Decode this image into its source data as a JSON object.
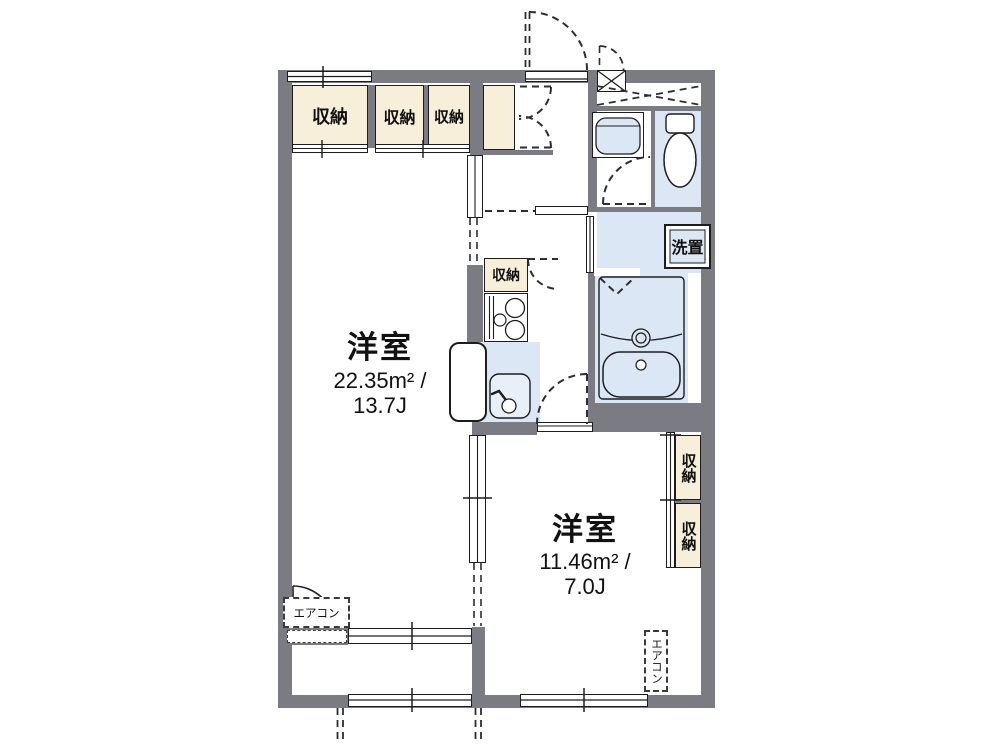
{
  "floor_plan": {
    "room_living": {
      "name": "洋室",
      "area_line1": "22.35m² /",
      "area_line2": "13.7J"
    },
    "room_bed": {
      "name": "洋室",
      "area_line1": "11.46m² /",
      "area_line2": "7.0J"
    },
    "closet_label": "収納",
    "washer_label": "洗置",
    "aircon_label": "エアコン",
    "colors": {
      "wall": "#7b7b84",
      "closet": "#f8efda",
      "water": "#dce7f6",
      "line": "#1d1d1f",
      "background": "#ffffff"
    }
  }
}
